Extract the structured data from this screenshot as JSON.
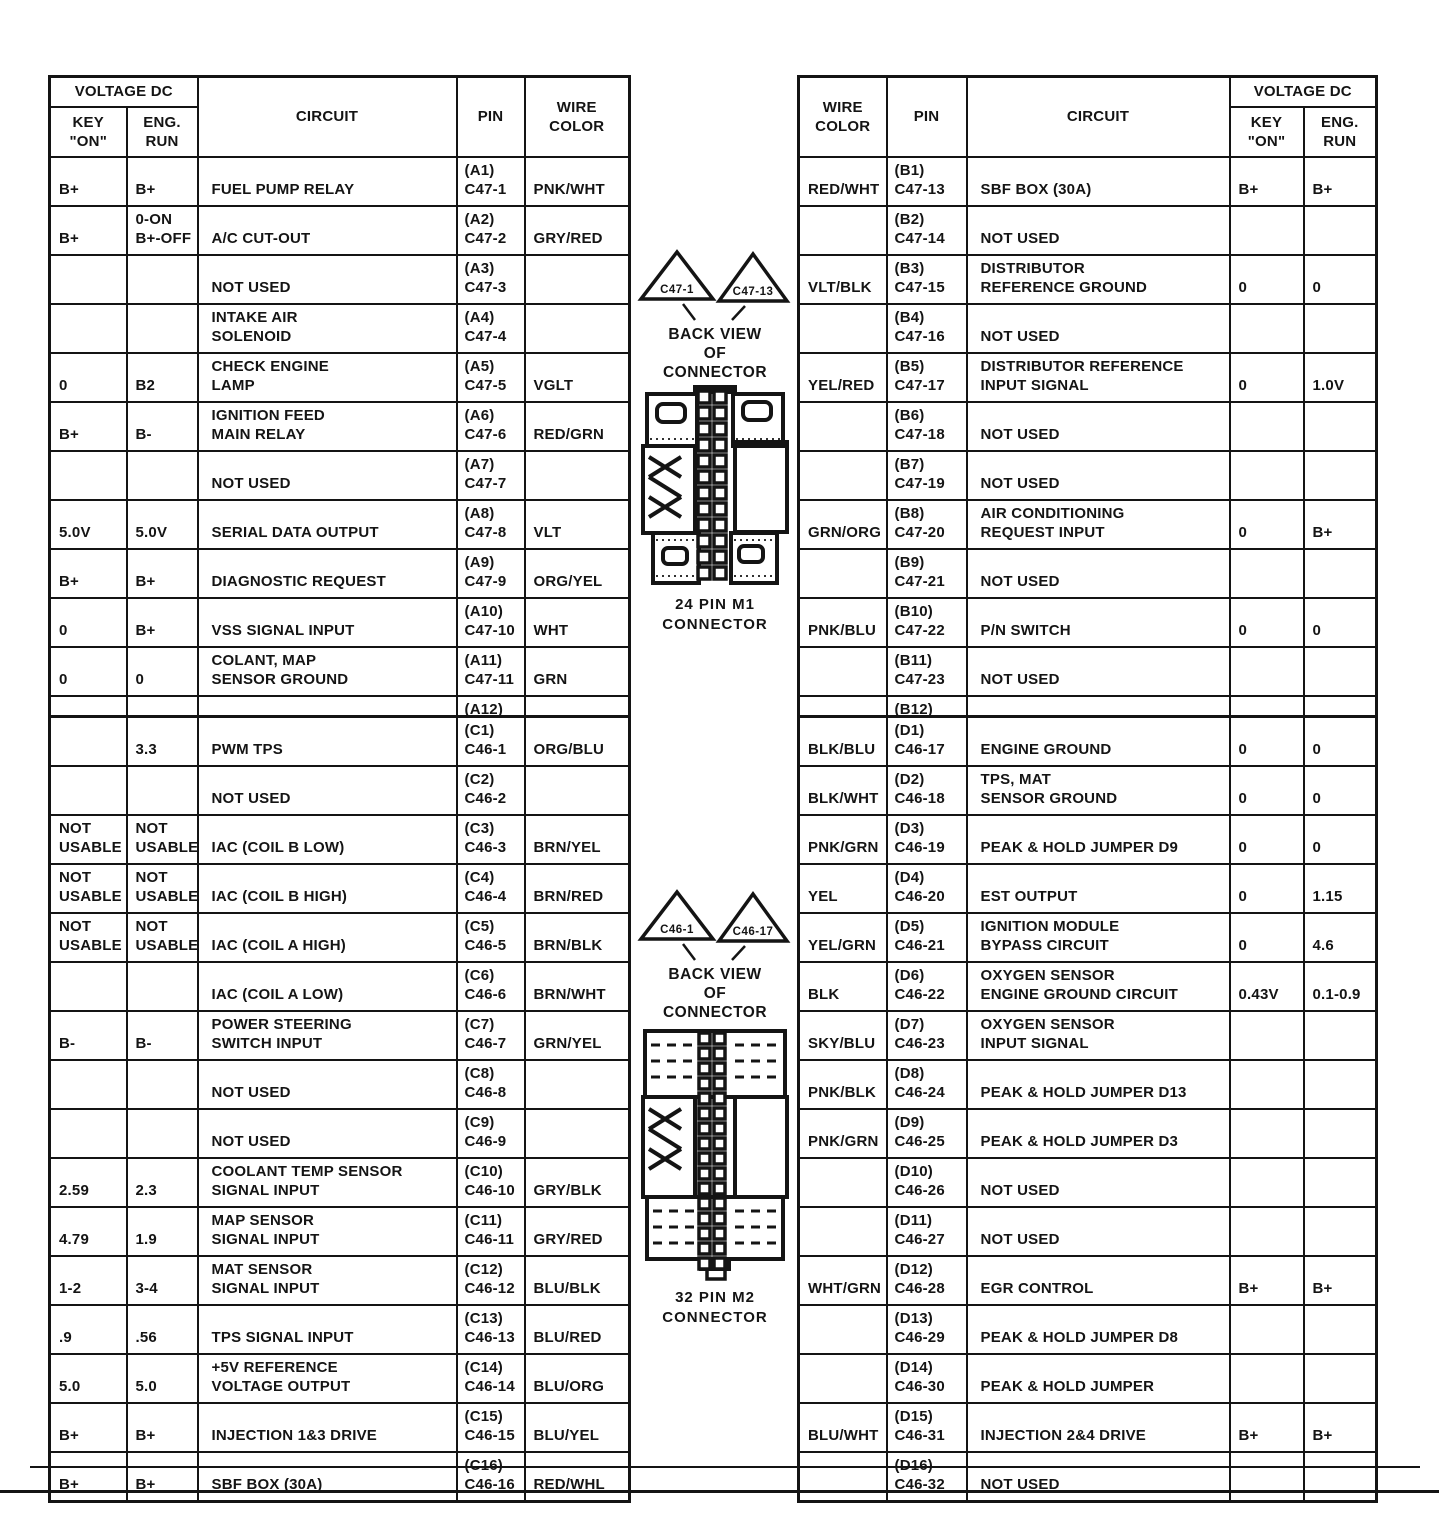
{
  "page": {
    "background": "#ffffff",
    "ink": "#141414"
  },
  "headers": {
    "voltage_dc": "VOLTAGE DC",
    "key_on": "KEY\n\"ON\"",
    "eng_run": "ENG.\nRUN",
    "circuit": "CIRCUIT",
    "pin": "PIN",
    "wire_color": "WIRE\nCOLOR"
  },
  "tables": {
    "m1_left": {
      "rows": [
        {
          "key_on": "B+",
          "eng_run": "B+",
          "circuit": "FUEL PUMP RELAY",
          "pin": "(A1)\nC47-1",
          "wire": "PNK/WHT"
        },
        {
          "key_on": "B+",
          "eng_run": "0-ON\nB+-OFF",
          "circuit": "A/C CUT-OUT",
          "pin": "(A2)\nC47-2",
          "wire": "GRY/RED"
        },
        {
          "key_on": "",
          "eng_run": "",
          "circuit": "NOT USED",
          "pin": "(A3)\nC47-3",
          "wire": ""
        },
        {
          "key_on": "",
          "eng_run": "",
          "circuit": "INTAKE AIR\nSOLENOID",
          "pin": "(A4)\nC47-4",
          "wire": ""
        },
        {
          "key_on": "0",
          "eng_run": "B2",
          "circuit": "CHECK ENGINE\nLAMP",
          "pin": "(A5)\nC47-5",
          "wire": "VGLT"
        },
        {
          "key_on": "B+",
          "eng_run": "B-",
          "circuit": "IGNITION FEED\nMAIN RELAY",
          "pin": "(A6)\nC47-6",
          "wire": "RED/GRN"
        },
        {
          "key_on": "",
          "eng_run": "",
          "circuit": "NOT USED",
          "pin": "(A7)\nC47-7",
          "wire": ""
        },
        {
          "key_on": "5.0V",
          "eng_run": "5.0V",
          "circuit": "SERIAL DATA OUTPUT",
          "pin": "(A8)\nC47-8",
          "wire": "VLT"
        },
        {
          "key_on": "B+",
          "eng_run": "B+",
          "circuit": "DIAGNOSTIC REQUEST",
          "pin": "(A9)\nC47-9",
          "wire": "ORG/YEL"
        },
        {
          "key_on": "0",
          "eng_run": "B+",
          "circuit": "VSS SIGNAL INPUT",
          "pin": "(A10)\nC47-10",
          "wire": "WHT"
        },
        {
          "key_on": "0",
          "eng_run": "0",
          "circuit": "COLANT, MAP\nSENSOR GROUND",
          "pin": "(A11)\nC47-11",
          "wire": "GRN"
        },
        {
          "key_on": "0",
          "eng_run": "0",
          "circuit": "ENGINE GROUND",
          "pin": "(A12)\nC47-12",
          "wire": "BLK/BLU"
        }
      ]
    },
    "m1_right": {
      "rows": [
        {
          "wire": "RED/WHT",
          "pin": "(B1)\nC47-13",
          "circuit": "SBF BOX (30A)",
          "key_on": "B+",
          "eng_run": "B+"
        },
        {
          "wire": "",
          "pin": "(B2)\nC47-14",
          "circuit": "NOT USED",
          "key_on": "",
          "eng_run": ""
        },
        {
          "wire": "VLT/BLK",
          "pin": "(B3)\nC47-15",
          "circuit": "DISTRIBUTOR\nREFERENCE GROUND",
          "key_on": "0",
          "eng_run": "0"
        },
        {
          "wire": "",
          "pin": "(B4)\nC47-16",
          "circuit": "NOT USED",
          "key_on": "",
          "eng_run": ""
        },
        {
          "wire": "YEL/RED",
          "pin": "(B5)\nC47-17",
          "circuit": "DISTRIBUTOR REFERENCE\nINPUT SIGNAL",
          "key_on": "0",
          "eng_run": "1.0V"
        },
        {
          "wire": "",
          "pin": "(B6)\nC47-18",
          "circuit": "NOT USED",
          "key_on": "",
          "eng_run": ""
        },
        {
          "wire": "",
          "pin": "(B7)\nC47-19",
          "circuit": "NOT USED",
          "key_on": "",
          "eng_run": ""
        },
        {
          "wire": "GRN/ORG",
          "pin": "(B8)\nC47-20",
          "circuit": "AIR CONDITIONING\nREQUEST INPUT",
          "key_on": "0",
          "eng_run": "B+"
        },
        {
          "wire": "",
          "pin": "(B9)\nC47-21",
          "circuit": "NOT USED",
          "key_on": "",
          "eng_run": ""
        },
        {
          "wire": "PNK/BLU",
          "pin": "(B10)\nC47-22",
          "circuit": "P/N SWITCH",
          "key_on": "0",
          "eng_run": "0"
        },
        {
          "wire": "",
          "pin": "(B11)\nC47-23",
          "circuit": "NOT USED",
          "key_on": "",
          "eng_run": ""
        },
        {
          "wire": "",
          "pin": "(B12)\nC47-24",
          "circuit": "NOT USED",
          "key_on": "",
          "eng_run": ""
        }
      ]
    },
    "m2_left": {
      "rows": [
        {
          "key_on": "",
          "eng_run": "3.3",
          "circuit": "PWM TPS",
          "pin": "(C1)\nC46-1",
          "wire": "ORG/BLU"
        },
        {
          "key_on": "",
          "eng_run": "",
          "circuit": "NOT USED",
          "pin": "(C2)\nC46-2",
          "wire": ""
        },
        {
          "key_on": "NOT\nUSABLE",
          "eng_run": "NOT\nUSABLE",
          "circuit": "IAC (COIL B LOW)",
          "pin": "(C3)\nC46-3",
          "wire": "BRN/YEL"
        },
        {
          "key_on": "NOT\nUSABLE",
          "eng_run": "NOT\nUSABLE",
          "circuit": "IAC (COIL B HIGH)",
          "pin": "(C4)\nC46-4",
          "wire": "BRN/RED"
        },
        {
          "key_on": "NOT\nUSABLE",
          "eng_run": "NOT\nUSABLE",
          "circuit": "IAC (COIL A HIGH)",
          "pin": "(C5)\nC46-5",
          "wire": "BRN/BLK"
        },
        {
          "key_on": "",
          "eng_run": "",
          "circuit": "IAC (COIL A LOW)",
          "pin": "(C6)\nC46-6",
          "wire": "BRN/WHT"
        },
        {
          "key_on": "B-",
          "eng_run": "B-",
          "circuit": "POWER STEERING\nSWITCH INPUT",
          "pin": "(C7)\nC46-7",
          "wire": "GRN/YEL"
        },
        {
          "key_on": "",
          "eng_run": "",
          "circuit": "NOT USED",
          "pin": "(C8)\nC46-8",
          "wire": ""
        },
        {
          "key_on": "",
          "eng_run": "",
          "circuit": "NOT USED",
          "pin": "(C9)\nC46-9",
          "wire": ""
        },
        {
          "key_on": "2.59",
          "eng_run": "2.3",
          "circuit": "COOLANT TEMP SENSOR\nSIGNAL INPUT",
          "pin": "(C10)\nC46-10",
          "wire": "GRY/BLK"
        },
        {
          "key_on": "4.79",
          "eng_run": "1.9",
          "circuit": "MAP SENSOR\nSIGNAL INPUT",
          "pin": "(C11)\nC46-11",
          "wire": "GRY/RED"
        },
        {
          "key_on": "1-2",
          "eng_run": "3-4",
          "circuit": "MAT SENSOR\nSIGNAL INPUT",
          "pin": "(C12)\nC46-12",
          "wire": "BLU/BLK"
        },
        {
          "key_on": ".9",
          "eng_run": ".56",
          "circuit": "TPS SIGNAL INPUT",
          "pin": "(C13)\nC46-13",
          "wire": "BLU/RED"
        },
        {
          "key_on": "5.0",
          "eng_run": "5.0",
          "circuit": "+5V REFERENCE\nVOLTAGE OUTPUT",
          "pin": "(C14)\nC46-14",
          "wire": "BLU/ORG"
        },
        {
          "key_on": "B+",
          "eng_run": "B+",
          "circuit": "INJECTION 1&3 DRIVE",
          "pin": "(C15)\nC46-15",
          "wire": "BLU/YEL"
        },
        {
          "key_on": "B+",
          "eng_run": "B+",
          "circuit": "SBF BOX (30A)",
          "pin": "(C16)\nC46-16",
          "wire": "RED/WHL"
        }
      ]
    },
    "m2_right": {
      "rows": [
        {
          "wire": "BLK/BLU",
          "pin": "(D1)\nC46-17",
          "circuit": "ENGINE GROUND",
          "key_on": "0",
          "eng_run": "0"
        },
        {
          "wire": "BLK/WHT",
          "pin": "(D2)\nC46-18",
          "circuit": "TPS, MAT\nSENSOR GROUND",
          "key_on": "0",
          "eng_run": "0"
        },
        {
          "wire": "PNK/GRN",
          "pin": "(D3)\nC46-19",
          "circuit": "PEAK & HOLD JUMPER D9",
          "key_on": "0",
          "eng_run": "0"
        },
        {
          "wire": "YEL",
          "pin": "(D4)\nC46-20",
          "circuit": "EST OUTPUT",
          "key_on": "0",
          "eng_run": "1.15"
        },
        {
          "wire": "YEL/GRN",
          "pin": "(D5)\nC46-21",
          "circuit": "IGNITION MODULE\nBYPASS CIRCUIT",
          "key_on": "0",
          "eng_run": "4.6"
        },
        {
          "wire": "BLK",
          "pin": "(D6)\nC46-22",
          "circuit": "OXYGEN SENSOR\nENGINE GROUND CIRCUIT",
          "key_on": "0.43V",
          "eng_run": "0.1-0.9"
        },
        {
          "wire": "SKY/BLU",
          "pin": "(D7)\nC46-23",
          "circuit": "OXYGEN SENSOR\nINPUT SIGNAL",
          "key_on": "",
          "eng_run": ""
        },
        {
          "wire": "PNK/BLK",
          "pin": "(D8)\nC46-24",
          "circuit": "PEAK & HOLD JUMPER D13",
          "key_on": "",
          "eng_run": ""
        },
        {
          "wire": "PNK/GRN",
          "pin": "(D9)\nC46-25",
          "circuit": "PEAK & HOLD JUMPER D3",
          "key_on": "",
          "eng_run": ""
        },
        {
          "wire": "",
          "pin": "(D10)\nC46-26",
          "circuit": "NOT USED",
          "key_on": "",
          "eng_run": ""
        },
        {
          "wire": "",
          "pin": "(D11)\nC46-27",
          "circuit": "NOT USED",
          "key_on": "",
          "eng_run": ""
        },
        {
          "wire": "WHT/GRN",
          "pin": "(D12)\nC46-28",
          "circuit": "EGR CONTROL",
          "key_on": "B+",
          "eng_run": "B+"
        },
        {
          "wire": "",
          "pin": "(D13)\nC46-29",
          "circuit": "PEAK & HOLD JUMPER D8",
          "key_on": "",
          "eng_run": ""
        },
        {
          "wire": "",
          "pin": "(D14)\nC46-30",
          "circuit": "PEAK & HOLD JUMPER",
          "key_on": "",
          "eng_run": ""
        },
        {
          "wire": "BLU/WHT",
          "pin": "(D15)\nC46-31",
          "circuit": "INJECTION 2&4 DRIVE",
          "key_on": "B+",
          "eng_run": "B+"
        },
        {
          "wire": "",
          "pin": "(D16)\nC46-32",
          "circuit": "NOT USED",
          "key_on": "",
          "eng_run": ""
        }
      ]
    },
    "connectors": {
      "m1": {
        "triangle_left": "C47-1",
        "triangle_right": "C47-13",
        "caption": "BACK VIEW\nOF\nCONNECTOR",
        "label": "24 PIN M1\nCONNECTOR"
      },
      "m2": {
        "triangle_left": "C46-1",
        "triangle_right": "C46-17",
        "caption": "BACK VIEW\nOF\nCONNECTOR",
        "label": "32 PIN M2\nCONNECTOR"
      }
    }
  }
}
